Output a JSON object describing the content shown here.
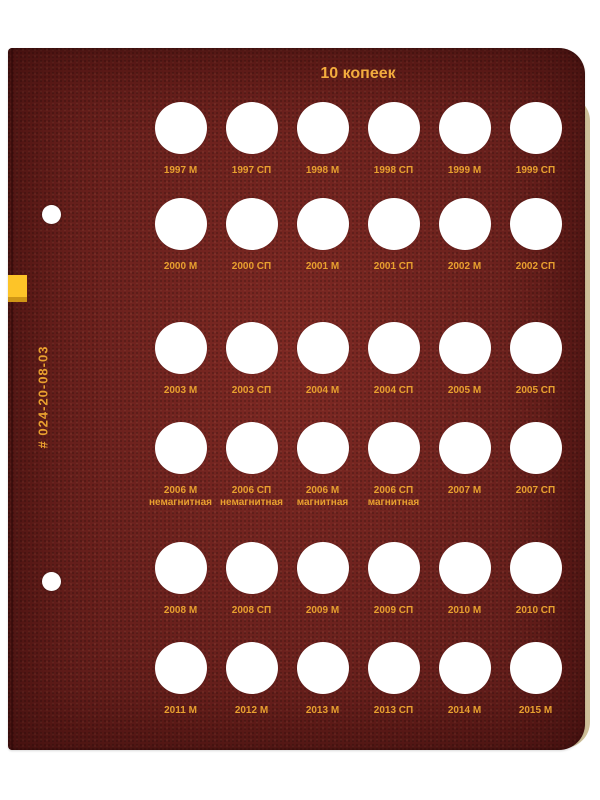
{
  "page": {
    "title": "10 копеек",
    "catalog_number": "# 024-20-08-03",
    "colors": {
      "page_background": "#6f201d",
      "title_text": "#f3ac3e",
      "label_text": "#e8a02f",
      "tab_yellow": "#fdc428",
      "tab_edge": "#cf9616",
      "under_page_edge": "#cfc09a"
    }
  },
  "grid": {
    "rows": [
      {
        "cells": [
          {
            "label": "1997 М"
          },
          {
            "label": "1997 СП"
          },
          {
            "label": "1998 М"
          },
          {
            "label": "1998 СП"
          },
          {
            "label": "1999 М"
          },
          {
            "label": "1999 СП"
          }
        ]
      },
      {
        "cells": [
          {
            "label": "2000 М"
          },
          {
            "label": "2000 СП"
          },
          {
            "label": "2001 М"
          },
          {
            "label": "2001 СП"
          },
          {
            "label": "2002 М"
          },
          {
            "label": "2002 СП"
          }
        ]
      },
      {
        "cells": [
          {
            "label": "2003 М"
          },
          {
            "label": "2003 СП"
          },
          {
            "label": "2004 М"
          },
          {
            "label": "2004 СП"
          },
          {
            "label": "2005 М"
          },
          {
            "label": "2005 СП"
          }
        ]
      },
      {
        "cells": [
          {
            "label": "2006 М",
            "sublabel": "немагнитная"
          },
          {
            "label": "2006 СП",
            "sublabel": "немагнитная"
          },
          {
            "label": "2006 М",
            "sublabel": "магнитная"
          },
          {
            "label": "2006 СП",
            "sublabel": "магнитная"
          },
          {
            "label": "2007 М"
          },
          {
            "label": "2007 СП"
          }
        ]
      },
      {
        "cells": [
          {
            "label": "2008 М"
          },
          {
            "label": "2008 СП"
          },
          {
            "label": "2009 М"
          },
          {
            "label": "2009 СП"
          },
          {
            "label": "2010 М"
          },
          {
            "label": "2010 СП"
          }
        ]
      },
      {
        "cells": [
          {
            "label": "2011 М"
          },
          {
            "label": "2012 М"
          },
          {
            "label": "2013 М"
          },
          {
            "label": "2013 СП"
          },
          {
            "label": "2014 М"
          },
          {
            "label": "2015 М"
          }
        ]
      }
    ]
  }
}
